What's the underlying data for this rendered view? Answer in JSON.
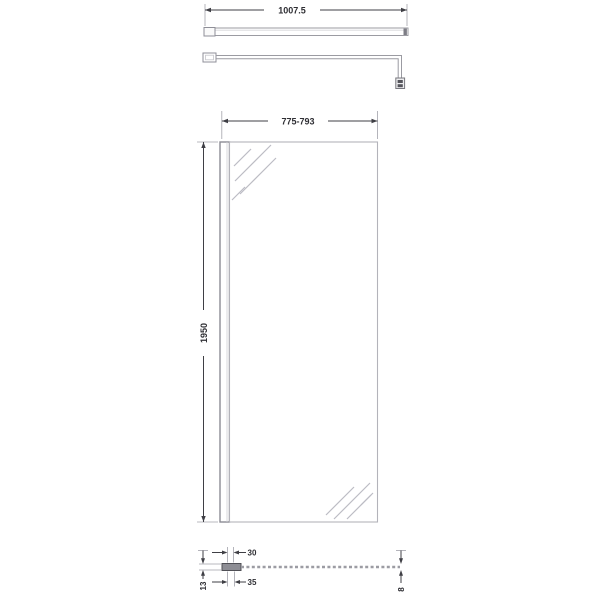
{
  "diagram": {
    "title": "Wetroom shower screen dimension drawing",
    "support_bar": {
      "length_label": "1007.5"
    },
    "screen_front": {
      "width_label": "775-793",
      "height_label": "1950"
    },
    "screen_plan": {
      "bracket_width_label": "30",
      "bracket_depth_label": "13",
      "profile_width_label": "35",
      "glass_thickness_label": "8"
    },
    "colors": {
      "outline_gray": "#9b9ba2",
      "dimension_dark": "#3f3f45",
      "extension_gray": "#a2a2aa",
      "glass_hatch_gray": "#bcbcc4",
      "profile_block_gray": "#8d8d94",
      "background": "#ffffff"
    }
  }
}
